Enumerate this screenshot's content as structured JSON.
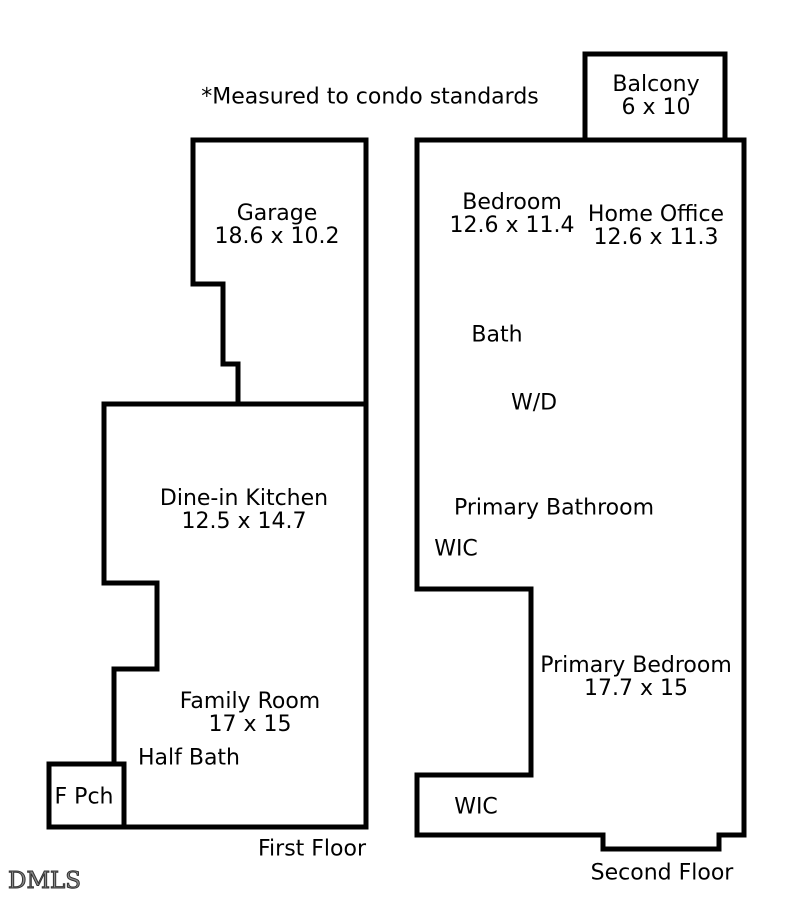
{
  "note": "*Measured to condo standards",
  "watermark": "DMLS",
  "colors": {
    "wall": "#000000",
    "text": "#000000",
    "background": "#ffffff"
  },
  "first_floor": {
    "label": "First Floor",
    "garage_name": "Garage",
    "garage_dims": "18.6 x 10.2",
    "kitchen_name": "Dine-in Kitchen",
    "kitchen_dims": "12.5 x 14.7",
    "family_room_name": "Family Room",
    "family_room_dims": "17 x 15",
    "half_bath": "Half Bath",
    "front_porch": "F Pch"
  },
  "second_floor": {
    "label": "Second Floor",
    "balcony_name": "Balcony",
    "balcony_dims": "6 x 10",
    "bedroom_name": "Bedroom",
    "bedroom_dims": "12.6 x 11.4",
    "home_office_name": "Home Office",
    "home_office_dims": "12.6 x 11.3",
    "bath": "Bath",
    "washer_dryer": "W/D",
    "primary_bathroom": "Primary Bathroom",
    "wic_upper": "WIC",
    "primary_bedroom_name": "Primary Bedroom",
    "primary_bedroom_dims": "17.7 x 15",
    "wic_lower": "WIC"
  }
}
